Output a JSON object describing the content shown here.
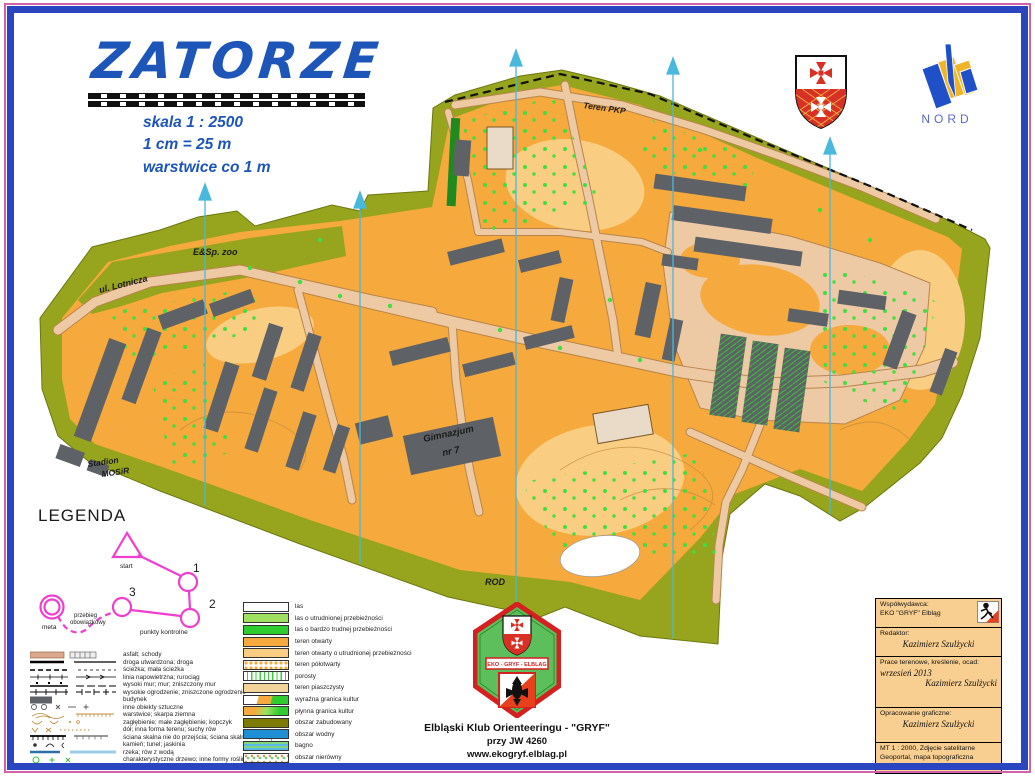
{
  "header": {
    "title": "ZATORZE",
    "scale_line1": "skala  1 : 2500",
    "scale_line2": "1  cm  = 25 m",
    "scale_line3": "warstwice co 1 m"
  },
  "logos": {
    "nord_label": "NORD"
  },
  "palette": {
    "title_blue": "#1D55B8",
    "frame_blue": "#2946C0",
    "frame_pink": "#D062A8",
    "open_orange": "#F6A93C",
    "pale_orange": "#F9CE83",
    "paved": "#EDC9A4",
    "olive_outofbounds": "#97A41D",
    "building_grey": "#5E6267",
    "tree_green": "#3FDF3F",
    "north_line_cyan": "#49B8DD",
    "course_magenta": "#EE3FD1",
    "water_blue": "#1E8FD5",
    "credits_bg": "#F8CF90"
  },
  "map_labels": {
    "teren_pkp": "Teren  PKP",
    "zoo": "E&Sp. zoo",
    "lotnicza": "ul. Lotnicza",
    "stadion_1": "Stadion",
    "stadion_2": "MOSiR",
    "gimnazjum_1": "Gimnazjum",
    "gimnazjum_2": "nr 7",
    "rod": "ROD"
  },
  "course_legend": {
    "title": "LEGENDA",
    "start": "start",
    "meta": "meta",
    "route_1": "przebieg",
    "route_2": "obowiązkowy",
    "controls": "punkty  kontrolne",
    "num1": "1",
    "num2": "2",
    "num3": "3"
  },
  "legend_lines": {
    "items": [
      "asfalt; schody",
      "droga utwardzona; droga",
      "ścieżka; mała ścieżka",
      "linia napowietrzna; rurociąg",
      "wysoki mur; mur; zniszczony mur",
      "wysokie ogrodzenie; zniszczone ogrodzenie",
      "budynek",
      "inne obiekty sztuczne",
      "warstwice; skarpa ziemna",
      "zagłębienie; małe zagłębienie; kopczyk",
      "dół; inna forma terenu; suchy rów",
      "ściana skalna nie do przejścia; ściana skalna do przejścia",
      "kamień; tunel; jaskinia",
      "rzeka; rów z wodą",
      "charakterystyczne drzewo; inne formy roślinne"
    ]
  },
  "legend_colors": {
    "items": [
      {
        "label": "las"
      },
      {
        "label": "las o utrudnionej przebieżności"
      },
      {
        "label": "las o bardzo trudnej przebieżności"
      },
      {
        "label": "teren otwarty"
      },
      {
        "label": "teren otwarty o utrudnionej przebieżności"
      },
      {
        "label": "teren półotwarty"
      },
      {
        "label": "porosty"
      },
      {
        "label": "teren piaszczysty"
      },
      {
        "label": "wyraźna granica kultur"
      },
      {
        "label": "płynna granica kultur"
      },
      {
        "label": "obszar zabudowany"
      },
      {
        "label": "obszar wodny"
      },
      {
        "label": "bagno"
      },
      {
        "label": "obszar nierówny"
      }
    ]
  },
  "club": {
    "badge_text": "EKO - GRYF - ELBLAG",
    "line1": "Elbląski Klub Orienteeringu - \"GRYF\"",
    "line2": "przy JW 4260",
    "line3": "www.ekogryf.elblag.pl"
  },
  "credits": {
    "r1a": "Współwydawca:",
    "r1b": "EKO \"GRYF\" Elbląg",
    "r2a": "Redaktor:",
    "r2b": "Kazimierz Szulżycki",
    "r3a": "Prace terenowe, kreślenie, ocad:",
    "r3b": "wrzesień 2013",
    "r3c": "Kazimierz Szulżycki",
    "r4a": "Opracowanie graficzne:",
    "r4b": "Kazimierz Szulżycki",
    "r5a": "MT 1 : 2000, Zdjęcie satelitarne",
    "r5b": "Geoportal, mapa topograficzna"
  }
}
